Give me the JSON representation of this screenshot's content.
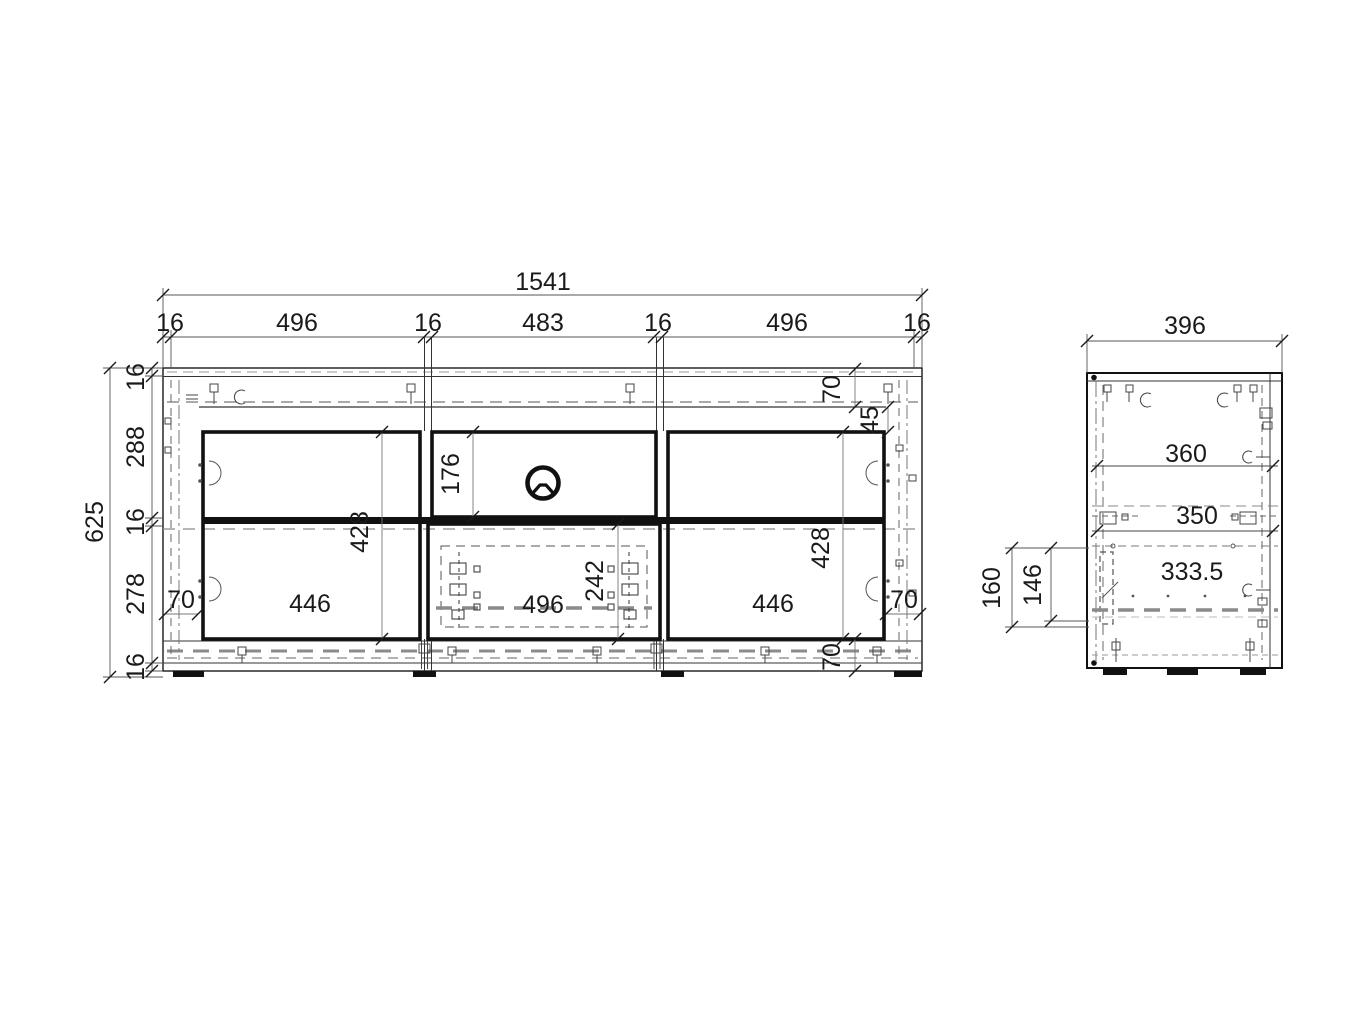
{
  "page": {
    "background": "#ffffff",
    "line_color": "#1a1a1a",
    "hidden_line_color": "#8a8a8a"
  },
  "front_view": {
    "overall_width": "1541",
    "top_segments": [
      "16",
      "496",
      "16",
      "483",
      "16",
      "496",
      "16"
    ],
    "overall_height": "625",
    "left_segments": [
      "16",
      "288",
      "16",
      "278",
      "16"
    ],
    "inner": {
      "niche_height": "176",
      "left_door_height": "428",
      "right_door_height": "428",
      "drawer_inner_height": "242",
      "left_width": "446",
      "center_width": "496",
      "right_width": "446",
      "left_offset": "70",
      "right_offset": "70",
      "top_rail": "70",
      "bottom_rail": "70",
      "top_gap": "45"
    }
  },
  "side_view": {
    "overall_depth": "396",
    "top_depth": "360",
    "mid_depth": "350",
    "bottom_depth": "333.5",
    "plinth_zone_height": "160",
    "drawer_zone_height": "146"
  },
  "icons": {
    "cable_hole": "cable-grommet-icon"
  }
}
